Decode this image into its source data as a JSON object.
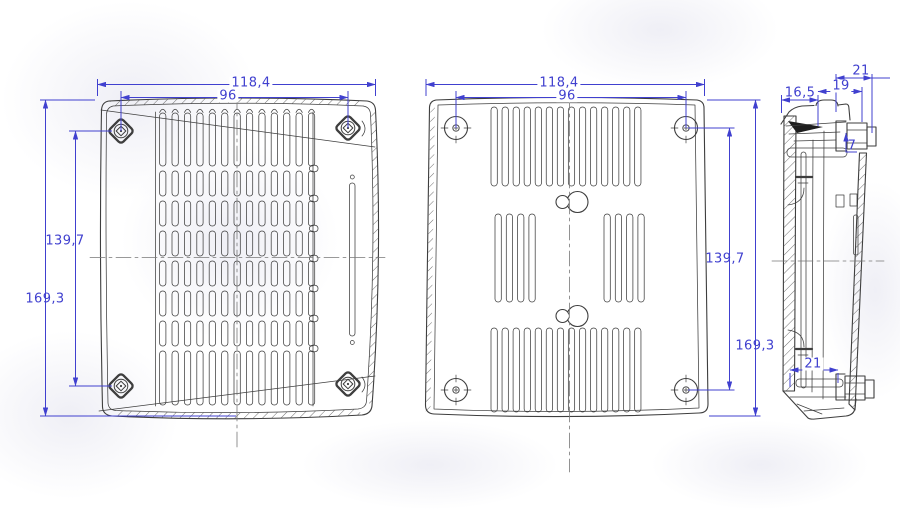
{
  "dimensions": {
    "front": {
      "overall_width": "118,4",
      "hole_spacing_width": "96",
      "hole_spacing_height": "139,7",
      "overall_height": "169,3"
    },
    "back": {
      "overall_width": "118,4",
      "hole_spacing_width": "96",
      "hole_spacing_height": "139,7",
      "overall_height": "169,3"
    },
    "side": {
      "depth_front": "16,5",
      "depth_middle": "19",
      "depth_top": "21",
      "clip_height": "7",
      "depth_bottom": "21"
    }
  },
  "colors": {
    "dimension": "#4040cf",
    "line": "#3e3e3e",
    "background": "#ffffff"
  }
}
